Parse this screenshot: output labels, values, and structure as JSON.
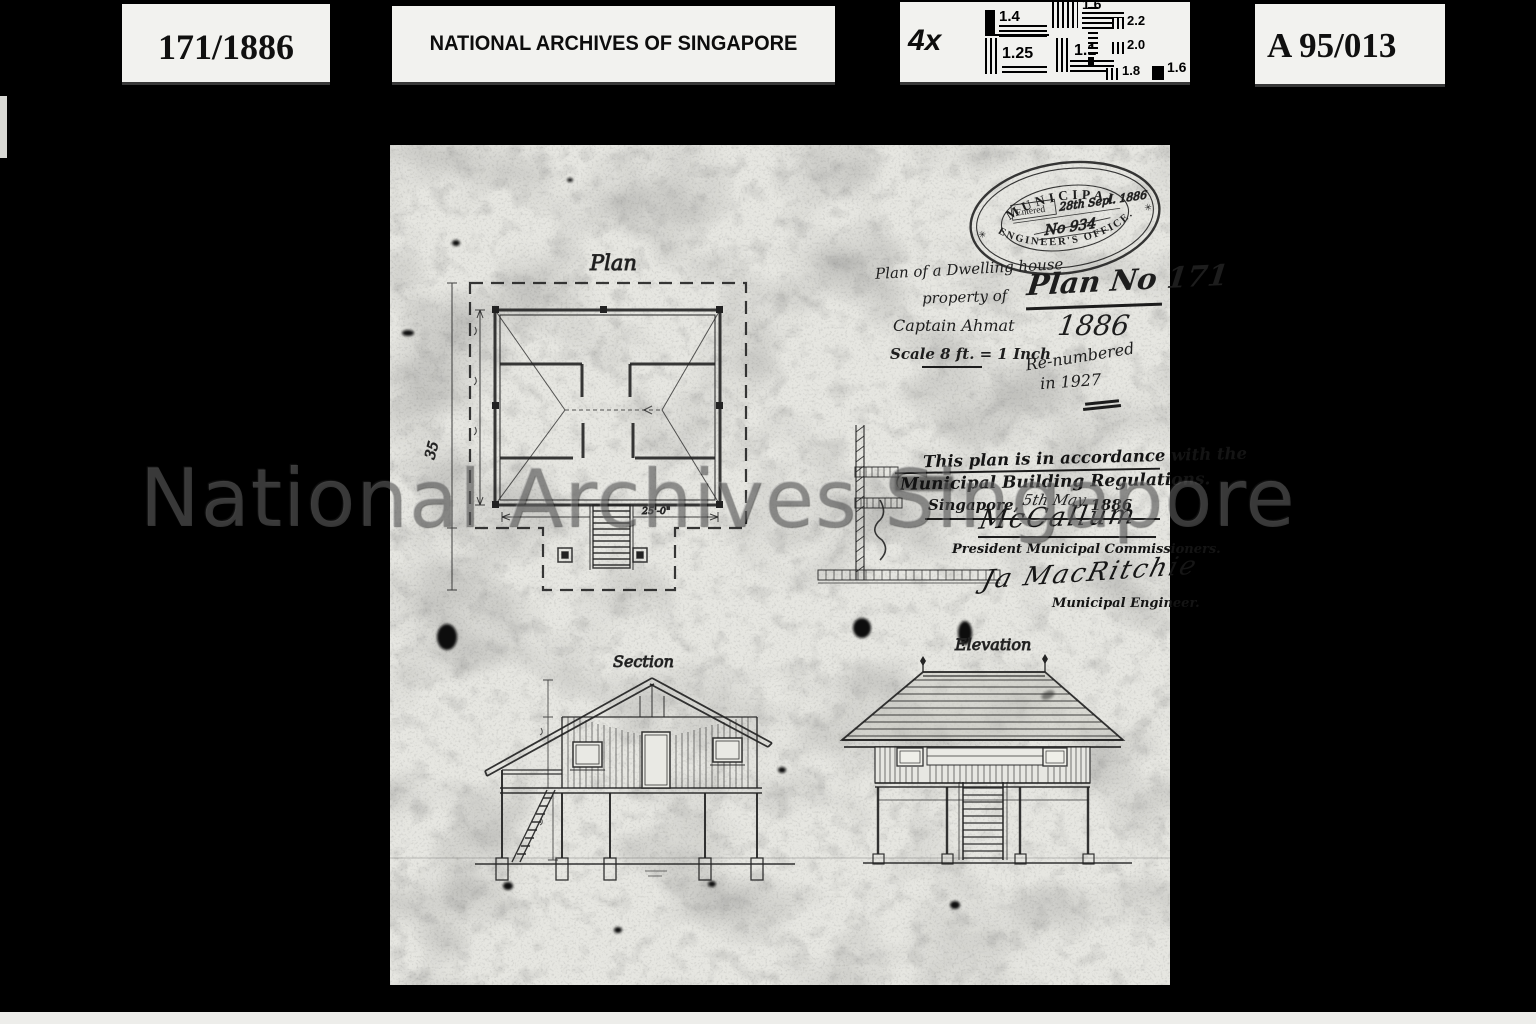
{
  "header": {
    "reel_label": "171/1886",
    "archive_title": "NATIONAL ARCHIVES OF SINGAPORE",
    "magnification": "4x",
    "reference_label": "A 95/013",
    "test_chart": {
      "left_group": [
        "1.4",
        "1.6",
        "1.25",
        "1.1"
      ],
      "right_group": [
        "2.2",
        "2.0",
        "1.8",
        "1.6"
      ]
    }
  },
  "watermark": "National Archives Singapore",
  "stamp": {
    "arc_top": "MUNICIPAL",
    "arc_bottom": "ENGINEER'S OFFICE.",
    "entered_label": "Entered",
    "entered_value": "28th Sepl. 1886",
    "number_value": "No 934",
    "star": "✳"
  },
  "notes": {
    "line1": "Plan of a Dwelling house",
    "line2": "property of",
    "line3": "Captain Ahmat",
    "line4": "Scale 8 ft. = 1 Inch",
    "plan_no": "Plan No 171",
    "year": "1886",
    "renumbered_1": "Re-numbered",
    "renumbered_2": "in 1927",
    "margin_note": "35"
  },
  "certification": {
    "line1": "This plan is in accordance with the",
    "line2": "Municipal Building Regulations.",
    "place": "Singapore,",
    "date_handwritten": "5th May",
    "year": "1886",
    "signature1": "McCallum",
    "title1": "President Municipal Commissioners.",
    "signature2": "Ja MacRitchie",
    "title2": "Municipal Engineer."
  },
  "drawings": {
    "plan_label": "Plan",
    "section_label": "Section",
    "elevation_label": "Elevation",
    "plan_width_dim": "25'-0\""
  }
}
